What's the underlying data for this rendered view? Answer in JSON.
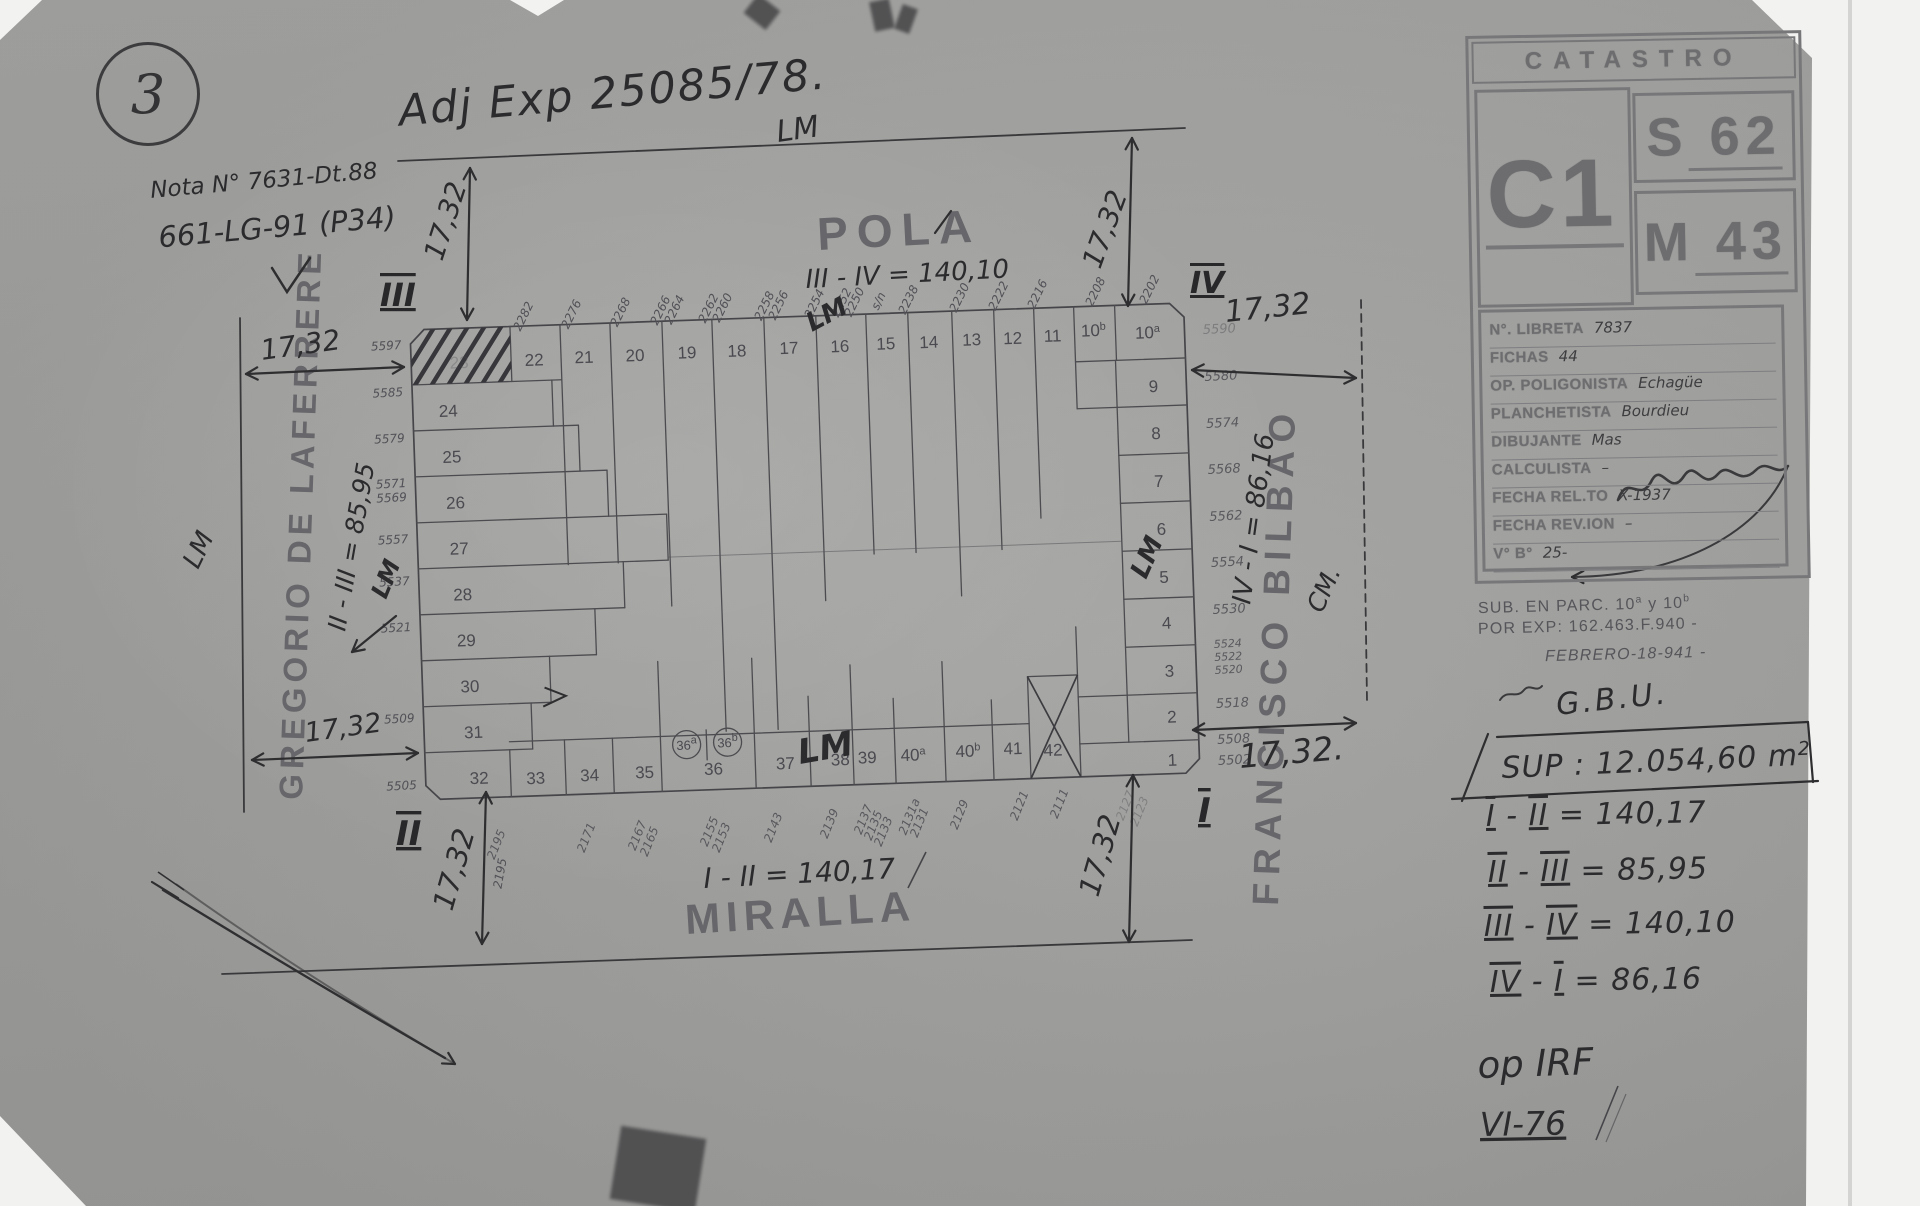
{
  "page": {
    "badge": "3"
  },
  "handwriting": {
    "adj_exp": "Adj Exp 25085/78.",
    "nota_line1": "Nota N° 7631-Dt.88",
    "nota_line2": "661-LG-91 (P34)",
    "lm": "LM",
    "cm": "CM.",
    "dim": "17,32",
    "dim_dot": "17,32.",
    "axis_number": "2195"
  },
  "plan": {
    "streets": {
      "top": "POLA",
      "bottom": "MIRALLA",
      "left": "GREGORIO DE LAFERRERE",
      "right": "FRANCISCO BILBAO"
    },
    "equations": {
      "top": "III - IV = 140,10",
      "bottom": "I - II = 140,17",
      "left": "II - III = 85,95",
      "right": "IV - I = 86,16"
    },
    "corner_numerals": {
      "top_left": "III",
      "top_right": "IV",
      "bottom_left": "II",
      "bottom_right": "I"
    },
    "parcels": {
      "top_row": [
        "23",
        "22",
        "21",
        "20",
        "19",
        "18",
        "17",
        "16",
        "15",
        "14",
        "13",
        "12",
        "11",
        "10b",
        "10a"
      ],
      "left_col": [
        "24",
        "25",
        "26",
        "27",
        "28",
        "29",
        "30",
        "31",
        "32"
      ],
      "right_col": [
        "9",
        "8",
        "7",
        "6",
        "5",
        "4",
        "3",
        "2",
        "1"
      ],
      "bottom_row": [
        "33",
        "34",
        "35",
        "36",
        "37",
        "38",
        "39",
        "40a",
        "40b",
        "41",
        "42"
      ],
      "circled": [
        "36a",
        "36b"
      ]
    },
    "street_numbers": {
      "top": [
        "2282",
        "2276",
        "2268",
        "2266",
        "2264",
        "2262",
        "2260",
        "2258",
        "2256",
        "2254",
        "2252",
        "2250",
        "s/n",
        "2238",
        "2230",
        "2222",
        "2216",
        "2208",
        "2202"
      ],
      "left": [
        "5597",
        "5585",
        "5579",
        "5571",
        "5569",
        "5557",
        "5537",
        "5521",
        "5509",
        "5505"
      ],
      "right": [
        "5590",
        "5580",
        "5574",
        "5568",
        "5562",
        "5554",
        "5530",
        "5524",
        "5522",
        "5520",
        "5518",
        "5508",
        "5502"
      ],
      "bottom": [
        "2195",
        "2171",
        "2167",
        "2165",
        "2155",
        "2153",
        "2143",
        "2139",
        "2137",
        "2135",
        "2133",
        "2131a",
        "2131",
        "2129",
        "2121",
        "2111",
        "2127",
        "2123"
      ]
    }
  },
  "stamp": {
    "title": "CATASTRO",
    "c_block": "C1",
    "s_block": "S62",
    "m_block": "M43",
    "fields": [
      {
        "label": "N°. LIBRETA",
        "value": "7837"
      },
      {
        "label": "FICHAS",
        "value": "44"
      },
      {
        "label": "OP. POLIGONISTA",
        "value": "Echagüe"
      },
      {
        "label": "PLANCHETISTA",
        "value": "Bourdieu"
      },
      {
        "label": "DIBUJANTE",
        "value": "Mas"
      },
      {
        "label": "CALCULISTA",
        "value": "–"
      },
      {
        "label": "FECHA REL.TO",
        "value": "X-1937"
      },
      {
        "label": "FECHA REV.ION",
        "value": "–"
      },
      {
        "label": "V° B°",
        "value": "25-"
      }
    ]
  },
  "notes": {
    "sub_parc": {
      "prefix": "SUB. EN PARC. 10",
      "sup1": "a",
      "mid": " y 10",
      "sup2": "b"
    },
    "por_exp": "POR EXP: 162.463.F.940 -",
    "fecha": "FEBRERO-18-941 -",
    "firma": "G.B.U.",
    "sup": {
      "label": "SUP :",
      "value": "12.054,60",
      "unit_base": "m",
      "unit_exp": "2"
    },
    "equations": [
      {
        "a": "I",
        "b": "II",
        "value": "140,17"
      },
      {
        "a": "II",
        "b": "III",
        "value": "85,95"
      },
      {
        "a": "III",
        "b": "IV",
        "value": "140,10"
      },
      {
        "a": "IV",
        "b": "I",
        "value": "86,16"
      }
    ],
    "op_ref": "op IRF",
    "vi_ref": "VI-76"
  }
}
